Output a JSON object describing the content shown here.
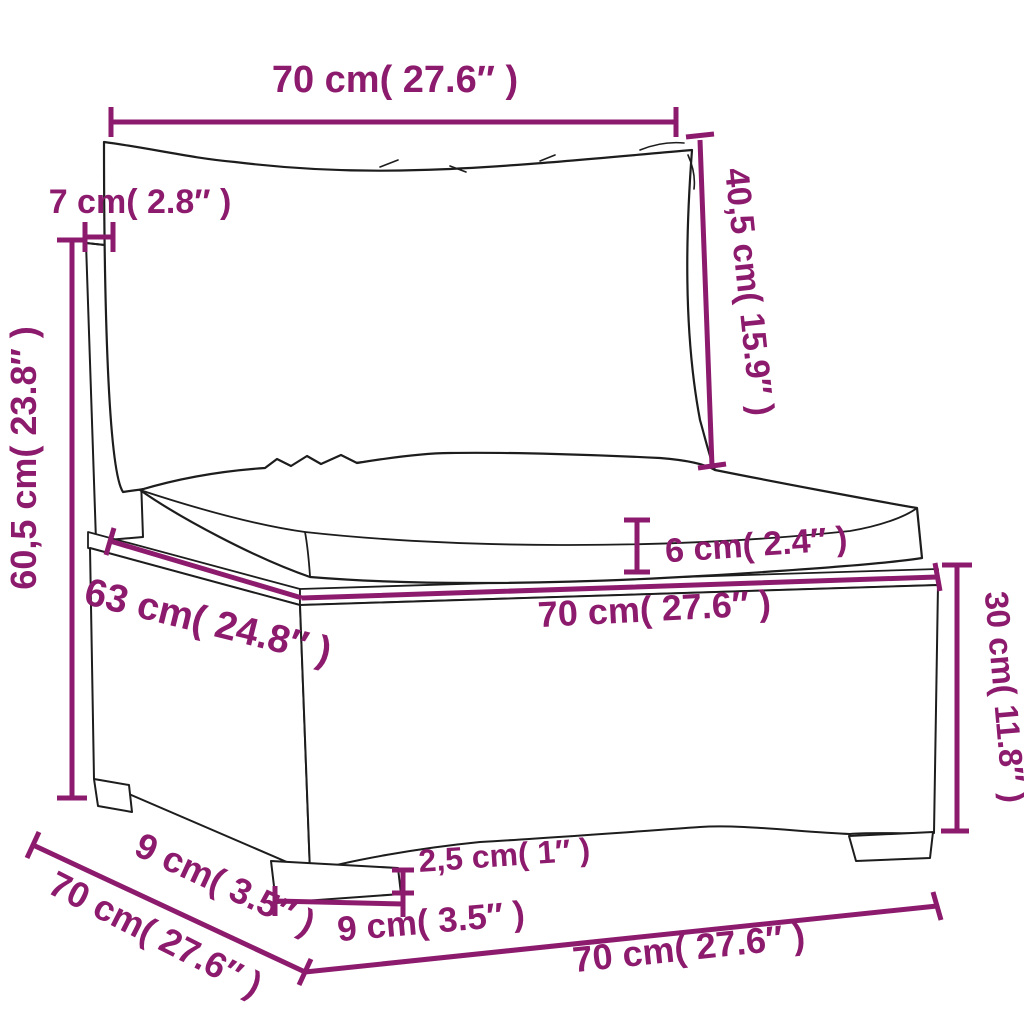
{
  "colors": {
    "dimension_accent": "#8D1B6D",
    "line_art": "#1d1d1d",
    "background": "#ffffff"
  },
  "dims": {
    "back_cushion_width": {
      "label": "70 cm( 27.6″ )"
    },
    "back_panel_thickness": {
      "label": "7 cm( 2.8″ )"
    },
    "back_cushion_height": {
      "label": "40,5 cm( 15.9″ )"
    },
    "total_height": {
      "label": "60,5 cm( 23.8″ )"
    },
    "seat_cushion_thickness": {
      "label": "6 cm( 2.4″ )"
    },
    "seat_depth": {
      "label": "63 cm( 24.8″ )"
    },
    "seat_width": {
      "label": "70 cm( 27.6″ )"
    },
    "base_height": {
      "label": "30 cm( 11.8″ )"
    },
    "foot_height": {
      "label": "2,5 cm( 1″ )"
    },
    "foot_width": {
      "label": "9 cm( 3.5″ )"
    },
    "side_foot_width": {
      "label": "9 cm( 3.5″ )"
    },
    "side_bottom_depth": {
      "label": "70 cm( 27.6″ )"
    },
    "front_bottom_width": {
      "label": "70 cm( 27.6″ )"
    }
  }
}
